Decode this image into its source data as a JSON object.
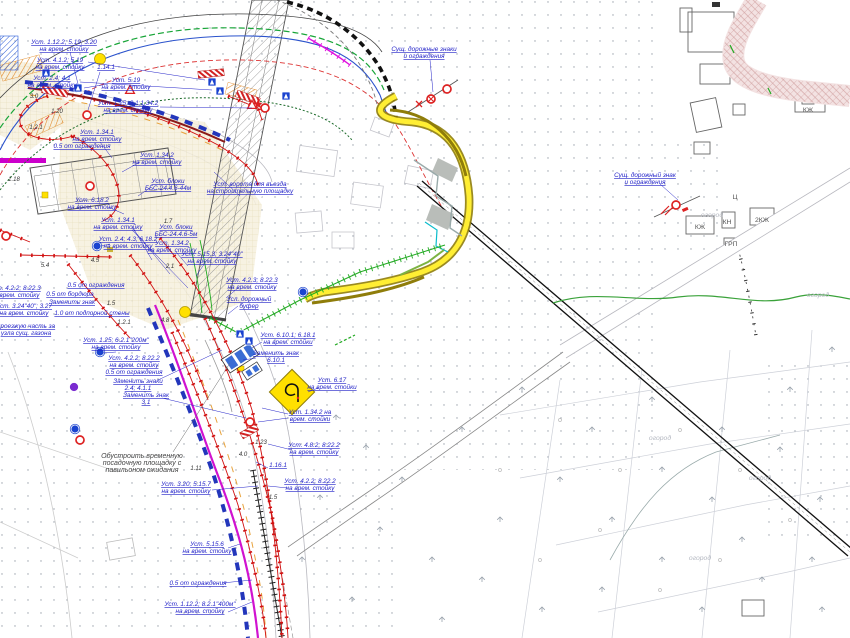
{
  "drawing": {
    "kind": "traffic-management-site-plan",
    "language": "ru",
    "background": "#ffffff"
  },
  "colors": {
    "annotation_blue": "#2424c9",
    "temp_fence_red": "#d11111",
    "route_magenta": "#d012d0",
    "detour_yellow": "#ffee33",
    "detour_olive": "#8f7d0a",
    "utility_green": "#18a538",
    "stream_green": "#3aa23a",
    "base_gray": "#b8b8bf",
    "sign_blue": "#1a43cf",
    "sign_red": "#dd2222",
    "hatch_pink": "#cf9c9c",
    "construction_cream": "#f6f0dd"
  },
  "annotations": [
    {
      "x": 64,
      "y": 44,
      "lines": [
        "Уст. 1.12.2; 5.19; 3.20",
        "на врем. стойку"
      ],
      "ldr": [
        [
          70,
          52,
          78,
          84
        ]
      ]
    },
    {
      "x": 60,
      "y": 62,
      "lines": [
        "Уст. 4.1.2; 5.19",
        "на врем. стойку"
      ],
      "ldr": [
        [
          88,
          62,
          205,
          80
        ]
      ]
    },
    {
      "x": 52,
      "y": 80,
      "lines": [
        "Уст. 2.4; 4.1",
        "на врем. стойку"
      ],
      "ldr": [
        [
          80,
          82,
          212,
          90
        ]
      ]
    },
    {
      "x": 106,
      "y": 69,
      "lines": [
        "1.14.1"
      ],
      "ldr": [
        [
          100,
          72,
          88,
          110
        ]
      ]
    },
    {
      "x": 126,
      "y": 82,
      "lines": [
        "Уст. 5.19",
        "на врем. стойку"
      ],
      "ldr": [
        [
          108,
          84,
          84,
          88
        ]
      ]
    },
    {
      "x": 128,
      "y": 105,
      "lines": [
        "Уст. 1.25; 3.1;1.34.2",
        "на врем. стойку"
      ],
      "ldr": [
        [
          160,
          107,
          252,
          108
        ]
      ]
    },
    {
      "x": 97,
      "y": 134,
      "lines": [
        "Уст. 1.34.1",
        "на врем. стойку"
      ],
      "ldr": [
        [
          100,
          142,
          112,
          158
        ]
      ]
    },
    {
      "x": 82,
      "y": 148,
      "lines": [
        "0.5 от ограждения"
      ]
    },
    {
      "x": 157,
      "y": 157,
      "lines": [
        "Уст. 1.34.2",
        "на врем. стойку"
      ],
      "ldr": [
        [
          140,
          162,
          122,
          172
        ]
      ]
    },
    {
      "x": 168,
      "y": 183,
      "lines": [
        "Уст. блоки",
        "ББС-24.4.6-44м"
      ],
      "ldr": [
        [
          150,
          188,
          138,
          196
        ]
      ]
    },
    {
      "x": 92,
      "y": 202,
      "lines": [
        "Уст. 6.18.2",
        "на врем. стойку"
      ],
      "ldr": [
        [
          108,
          207,
          124,
          214
        ]
      ]
    },
    {
      "x": 118,
      "y": 222,
      "lines": [
        "Уст. 1.34.1",
        "на врем. стойку"
      ],
      "ldr": [
        [
          132,
          226,
          152,
          260
        ],
        [
          132,
          228,
          170,
          274
        ],
        [
          132,
          230,
          188,
          288
        ]
      ]
    },
    {
      "x": 176,
      "y": 229,
      "lines": [
        "Уст. блоки",
        "ББС-24.4.6-5м"
      ]
    },
    {
      "x": 172,
      "y": 245,
      "lines": [
        "Уст. 1.34.2",
        "на врем. стойку"
      ],
      "ldr": [
        [
          176,
          252,
          188,
          266
        ]
      ]
    },
    {
      "x": 128,
      "y": 241,
      "lines": [
        "Уст. 2.4; 4.3; 6.18.2",
        "на врем. стойку"
      ],
      "ldr": [
        [
          110,
          244,
          101,
          246
        ]
      ]
    },
    {
      "x": 212,
      "y": 256,
      "lines": [
        "Уст. 5.15.3; 3.24\"40\"",
        "на врем. стойку"
      ],
      "ldr": [
        [
          205,
          263,
          196,
          276
        ]
      ]
    },
    {
      "x": 252,
      "y": 282,
      "lines": [
        "Уст. 4.2.3; 8.22.3",
        "на врем. стойку"
      ],
      "ldr": [
        [
          238,
          288,
          226,
          298
        ]
      ]
    },
    {
      "x": 249,
      "y": 301,
      "lines": [
        "Усл. дорожный",
        "буфер"
      ],
      "ldr": [
        [
          238,
          306,
          228,
          314
        ]
      ]
    },
    {
      "x": 288,
      "y": 337,
      "lines": [
        "Уст. 6.10.1; 6.18.1",
        "на врем. стойки"
      ],
      "ldr": [
        [
          262,
          342,
          252,
          348
        ]
      ]
    },
    {
      "x": 276,
      "y": 355,
      "lines": [
        "Заменить знак",
        "6.10.1"
      ],
      "ldr": [
        [
          256,
          358,
          243,
          360
        ]
      ]
    },
    {
      "x": 332,
      "y": 382,
      "lines": [
        "Уст. 6.17",
        "на врем. стойки"
      ],
      "ldr": [
        [
          318,
          388,
          308,
          392
        ]
      ]
    },
    {
      "x": 310,
      "y": 414,
      "lines": [
        "Уст. 1.34.2 на",
        "врем. стойки"
      ],
      "ldr": [
        [
          288,
          414,
          262,
          408
        ],
        [
          288,
          418,
          258,
          422
        ]
      ]
    },
    {
      "x": 314,
      "y": 447,
      "lines": [
        "Уст. 4.8.2; 8.22.2",
        "на врем. стойку"
      ],
      "ldr": [
        [
          292,
          450,
          268,
          444
        ]
      ]
    },
    {
      "x": 278,
      "y": 467,
      "lines": [
        "1.16.1"
      ],
      "ldr": [
        [
          268,
          468,
          256,
          462
        ]
      ]
    },
    {
      "x": 310,
      "y": 483,
      "lines": [
        "Уст. 4.2.2; 8.22.2",
        "на врем. стойку"
      ],
      "ldr": [
        [
          288,
          488,
          268,
          486
        ]
      ]
    },
    {
      "x": 186,
      "y": 486,
      "lines": [
        "Уст. 3.20; 5.15.7",
        "на врем. стойку"
      ],
      "ldr": [
        [
          212,
          490,
          258,
          486
        ]
      ]
    },
    {
      "x": 207,
      "y": 546,
      "lines": [
        "Уст. 5.15.6",
        "на врем. стойку"
      ],
      "ldr": [
        [
          228,
          548,
          240,
          544
        ]
      ]
    },
    {
      "x": 198,
      "y": 585,
      "lines": [
        "0.5 от ограждения"
      ],
      "ldr": [
        [
          222,
          583,
          252,
          580
        ]
      ]
    },
    {
      "x": 200,
      "y": 606,
      "lines": [
        "Уст. 1.12.2; 8.2.1\"400м\"",
        "на врем. стойку"
      ],
      "ldr": [
        [
          228,
          612,
          252,
          602
        ]
      ]
    },
    {
      "x": 138,
      "y": 383,
      "lines": [
        "Заменить знаки",
        "2.4; 4.1.1"
      ],
      "ldr": [
        [
          158,
          380,
          222,
          350
        ]
      ]
    },
    {
      "x": 146,
      "y": 397,
      "lines": [
        "Заменить знак",
        "3.1"
      ],
      "ldr": [
        [
          162,
          398,
          246,
          418
        ]
      ]
    },
    {
      "x": 116,
      "y": 342,
      "lines": [
        "Уст. 1.25; 6.2.1\"200м\"",
        "на врем. стойку"
      ],
      "ldr": [
        [
          116,
          352,
          103,
          353
        ]
      ]
    },
    {
      "x": 134,
      "y": 360,
      "lines": [
        "Уст. 4.2.2; 8.22.2",
        "на врем. стойку",
        "0.5 от ограждения"
      ]
    },
    {
      "x": 26,
      "y": 328,
      "lines": [
        "проезжую часть за",
        "узла сущ. газона"
      ]
    },
    {
      "x": 24,
      "y": 308,
      "lines": [
        "Уст. 3.24\"40\"; 3.27",
        "на врем. стойку"
      ]
    },
    {
      "x": 15,
      "y": 290,
      "lines": [
        "Уст. 4.2.2; 8.22.3",
        "на врем. стойку"
      ]
    },
    {
      "x": 70,
      "y": 296,
      "lines": [
        "0.5 от бордюра"
      ]
    },
    {
      "x": 72,
      "y": 304,
      "lines": [
        "Заменить знак"
      ]
    },
    {
      "x": 92,
      "y": 315,
      "lines": [
        "1.0 от подпорной стены"
      ]
    },
    {
      "x": 96,
      "y": 287,
      "lines": [
        "0.5 от ограждения"
      ]
    },
    {
      "x": 250,
      "y": 186,
      "lines": [
        "Уст. ворота для въезда",
        "на строительную площадку"
      ],
      "ldr": [
        [
          240,
          196,
          214,
          172
        ]
      ]
    },
    {
      "x": 424,
      "y": 51,
      "lines": [
        "Сущ. дорожные знаки",
        "и ограждения"
      ],
      "ldr": [
        [
          430,
          60,
          433,
          92
        ]
      ]
    },
    {
      "x": 645,
      "y": 177,
      "lines": [
        "Сущ. дорожный знак",
        "и ограждения"
      ],
      "ldr": [
        [
          660,
          184,
          678,
          200
        ]
      ]
    }
  ],
  "notes": [
    {
      "x": 142,
      "y": 458,
      "lines": [
        "Обустроить временную",
        "посадочную площадку с",
        "павильоном ожидания"
      ],
      "ldr": [
        [
          173,
          452,
          230,
          363
        ]
      ]
    }
  ],
  "dimensions": [
    {
      "x": 36,
      "y": 129,
      "t": "1.2.1"
    },
    {
      "x": 57,
      "y": 113,
      "t": "1.20"
    },
    {
      "x": 34,
      "y": 98,
      "t": "3.0"
    },
    {
      "x": 45,
      "y": 267,
      "t": "5.4"
    },
    {
      "x": 95,
      "y": 262,
      "t": "4.5"
    },
    {
      "x": 168,
      "y": 223,
      "t": "1.7"
    },
    {
      "x": 124,
      "y": 324,
      "t": "1.2.1"
    },
    {
      "x": 165,
      "y": 322,
      "t": "4.8"
    },
    {
      "x": 14,
      "y": 181,
      "t": "1.18"
    },
    {
      "x": 273,
      "y": 499,
      "t": "1.5"
    },
    {
      "x": 170,
      "y": 268,
      "t": "2.1"
    },
    {
      "x": 111,
      "y": 305,
      "t": "1.5"
    },
    {
      "x": 261,
      "y": 444,
      "t": "1.23"
    },
    {
      "x": 196,
      "y": 470,
      "t": "1.11"
    },
    {
      "x": 243,
      "y": 456,
      "t": "4.0"
    }
  ],
  "map_labels": [
    {
      "x": 700,
      "y": 229,
      "t": "КЖ"
    },
    {
      "x": 727,
      "y": 224,
      "t": "КН"
    },
    {
      "x": 731,
      "y": 246,
      "t": "ГРП"
    },
    {
      "x": 762,
      "y": 222,
      "t": "2КЖ"
    },
    {
      "x": 735,
      "y": 199,
      "t": "Ц"
    },
    {
      "x": 808,
      "y": 112,
      "t": "КЖ"
    },
    {
      "x": 712,
      "y": 217,
      "t": "огород",
      "faint": true
    },
    {
      "x": 818,
      "y": 297,
      "t": "огород",
      "faint": true
    },
    {
      "x": 660,
      "y": 440,
      "t": "огород",
      "faint": true
    },
    {
      "x": 700,
      "y": 560,
      "t": "огород",
      "faint": true
    },
    {
      "x": 760,
      "y": 480,
      "t": "огород",
      "faint": true
    }
  ],
  "signs": {
    "blue_square_positions": [
      [
        46,
        73
      ],
      [
        78,
        88
      ],
      [
        212,
        82
      ],
      [
        220,
        91
      ],
      [
        286,
        96
      ],
      [
        240,
        334
      ],
      [
        249,
        341
      ]
    ],
    "blue_circle_positions": [
      [
        97,
        246
      ],
      [
        303,
        292
      ],
      [
        100,
        352
      ],
      [
        75,
        429
      ]
    ],
    "violet_circle_positions": [
      [
        74,
        387
      ]
    ],
    "red_circle_positions": [
      [
        87,
        115
      ],
      [
        6,
        236
      ],
      [
        90,
        186
      ],
      [
        447,
        89
      ],
      [
        676,
        205
      ],
      [
        250,
        422
      ],
      [
        80,
        440
      ],
      [
        265,
        108
      ]
    ],
    "crossed_red_circle_positions": [
      [
        431,
        99
      ]
    ],
    "warning_triangle_positions": [
      [
        130,
        90
      ],
      [
        252,
        105
      ]
    ],
    "yellow_circle_positions": [
      [
        100,
        59
      ],
      [
        185,
        312
      ]
    ],
    "detour_sign": {
      "x": 292,
      "y": 392,
      "label": "6.17"
    }
  }
}
